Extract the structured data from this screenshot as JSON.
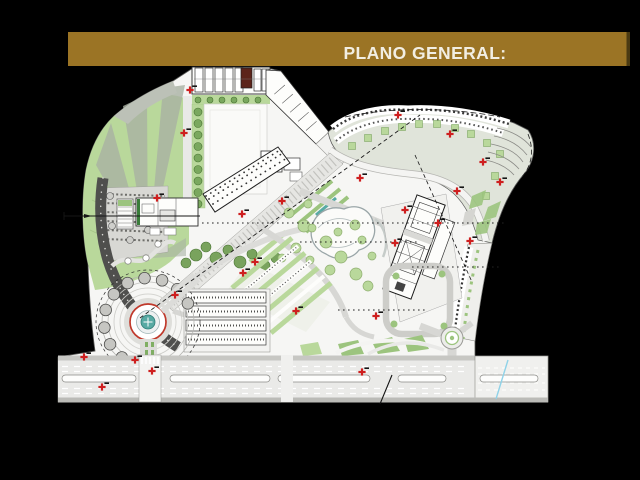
{
  "slide": {
    "background": "#000000"
  },
  "title_bar": {
    "label": "PLANO GENERAL:",
    "bg": "#9B7425",
    "shadow": "#4A3A12",
    "text_color": "#F2EEE3"
  },
  "plan": {
    "colors": {
      "paper": "#F6F6F4",
      "road": "#E9E9E7",
      "outline": "#2B2B2B",
      "green_light": "#B9D89B",
      "green_mid": "#9CC47E",
      "green_dark": "#6F9B53",
      "wedge_gray": "#A9B2A3",
      "texture_dark": "#4F4F4D",
      "red_marker": "#CE1F1F",
      "maroon_block": "#5C241A",
      "fountain_teal": "#58AAA4",
      "utility_cyan": "#8FD2E8"
    },
    "red_markers": [
      [
        190,
        90
      ],
      [
        184,
        133
      ],
      [
        157,
        198
      ],
      [
        242,
        214
      ],
      [
        282,
        201
      ],
      [
        255,
        262
      ],
      [
        243,
        273
      ],
      [
        175,
        295
      ],
      [
        135,
        360
      ],
      [
        152,
        371
      ],
      [
        102,
        387
      ],
      [
        84,
        357
      ],
      [
        360,
        178
      ],
      [
        398,
        115
      ],
      [
        450,
        134
      ],
      [
        483,
        162
      ],
      [
        500,
        182
      ],
      [
        457,
        191
      ],
      [
        405,
        210
      ],
      [
        395,
        243
      ],
      [
        438,
        223
      ],
      [
        470,
        241
      ],
      [
        376,
        316
      ],
      [
        296,
        311
      ],
      [
        362,
        372
      ]
    ],
    "street_trees": {
      "x": 198,
      "y_start": 112,
      "y_step": 11.5,
      "count": 9
    },
    "top_strip_trees": {
      "y": 100,
      "x_start": 198,
      "x_step": 12,
      "count": 6
    },
    "park_trees": [
      [
        289,
        213,
        5
      ],
      [
        304,
        226,
        6
      ],
      [
        326,
        242,
        6
      ],
      [
        341,
        257,
        6
      ],
      [
        356,
        274,
        6
      ],
      [
        368,
        286,
        5
      ],
      [
        312,
        228,
        4
      ],
      [
        355,
        225,
        5
      ],
      [
        338,
        232,
        4
      ],
      [
        296,
        248,
        5
      ],
      [
        282,
        258,
        4
      ],
      [
        308,
        204,
        4
      ],
      [
        362,
        240,
        4
      ],
      [
        372,
        256,
        4
      ],
      [
        310,
        260,
        4
      ],
      [
        330,
        270,
        5
      ]
    ],
    "band_courtyards": [
      [
        352,
        146
      ],
      [
        368,
        138
      ],
      [
        385,
        131
      ],
      [
        402,
        127
      ],
      [
        419,
        124
      ],
      [
        437,
        124
      ],
      [
        455,
        128
      ],
      [
        471,
        134
      ],
      [
        487,
        143
      ],
      [
        500,
        154
      ],
      [
        495,
        176
      ],
      [
        486,
        196
      ]
    ],
    "plaza": {
      "cx": 148,
      "cy": 322,
      "ring_radius": 18,
      "fountain_radius": 7,
      "tree_ring_radius": 44,
      "tree_count": 12,
      "tree_angle_start": 80,
      "tree_angle_end": 335
    },
    "road_medians": [
      [
        62,
        74
      ],
      [
        170,
        100
      ],
      [
        278,
        92
      ],
      [
        398,
        48
      ],
      [
        480,
        58
      ]
    ]
  }
}
